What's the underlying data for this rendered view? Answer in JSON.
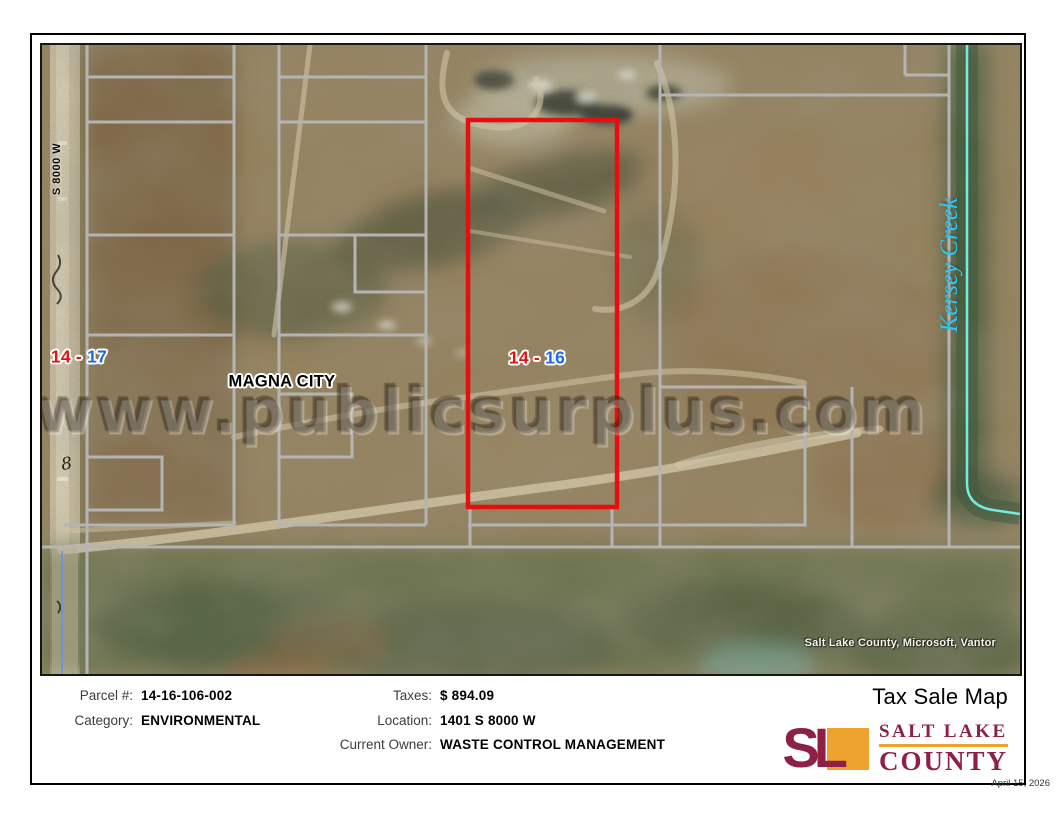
{
  "page": {
    "date": "April 15, 2026"
  },
  "map": {
    "watermark": "www.publicsurplus.com",
    "attribution": "Salt Lake County, Microsoft, Vantor",
    "road_label": "S 8000 W",
    "city_label": "MAGNA CITY",
    "creek_label": "Kersey Creek",
    "ground_mark": "8",
    "parcel_labels": {
      "left": {
        "first": "14",
        "sep": "-",
        "second": "17"
      },
      "selected": {
        "first": "14",
        "sep": "-",
        "second": "16"
      }
    },
    "colors": {
      "selected_outline": "#e60e0e",
      "parcel_line": "#b4b4b4",
      "creek_line": "#74ece2",
      "creek_label_color": "#2fc6ee",
      "label_red": "#e01212",
      "label_blue": "#1d6be0"
    }
  },
  "footer": {
    "title": "Tax Sale Map",
    "left_fields": [
      {
        "label": "Parcel #:",
        "value": "14-16-106-002"
      },
      {
        "label": "Category:",
        "value": "ENVIRONMENTAL"
      }
    ],
    "mid_fields": [
      {
        "label": "Taxes:",
        "value": "$ 894.09"
      },
      {
        "label": "Location:",
        "value": "1401 S 8000 W"
      },
      {
        "label": "Current Owner:",
        "value": "WASTE CONTROL MANAGEMENT"
      }
    ],
    "logo": {
      "monogram": "SL",
      "name_line1": "SALT LAKE",
      "name_line2": "COUNTY",
      "maroon": "#8e2044",
      "gold": "#eda32d"
    }
  }
}
